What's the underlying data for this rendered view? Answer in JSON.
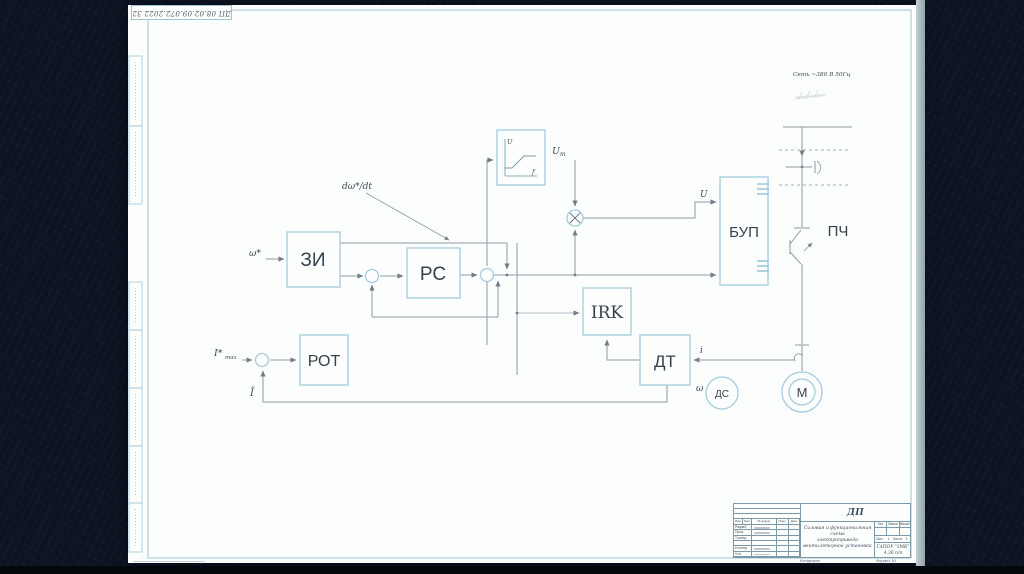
{
  "colors": {
    "background": "#0c1422",
    "sheet": "#fcfdfd",
    "frame_blue": "#9cc6d6",
    "block_blue": "#a3cbdc",
    "line_gray": "#8e9aa4",
    "text_dark": "#33424e"
  },
  "stamp": {
    "text": "ДП 08.02.09.072.2022 32"
  },
  "diagram": {
    "net": {
      "label": "Сеть ~380 В 50Гц"
    },
    "blocks": {
      "zi": "ЗИ",
      "rs": "РС",
      "rot": "РОТ",
      "irk": "IRK",
      "dt": "ДТ",
      "bup": "БУП",
      "pch": "ПЧ",
      "ds": "ДС",
      "motor": "М"
    },
    "labels": {
      "omega_star": "ω*",
      "domega": "dω*/dt",
      "um_base": "U",
      "um_sub": "m",
      "u": "U",
      "i": "i",
      "omega": "ω",
      "i_hat": "Î",
      "imax_base": "I*",
      "imax_sub": "max",
      "axis_u": "U",
      "axis_f": "f"
    }
  },
  "title_block": {
    "doc_number": "ДП 08.02.09.072.2022 32",
    "title_lines": [
      "Силовая и функциональная схема",
      "электропривода",
      "вентиляторной установки"
    ],
    "header_cols": [
      "Изм.",
      "Лист",
      "№ докум.",
      "Подп.",
      "Дата"
    ],
    "rows": [
      "Разраб.",
      "Пров.",
      "Т.контр.",
      "",
      "Н.контр.",
      "Утв."
    ],
    "lit_header": [
      "Лит.",
      "Масса",
      "Масштаб"
    ],
    "sheet_row": {
      "l1": "Лист",
      "v1": "1",
      "l2": "Листов",
      "v2": "1"
    },
    "org_lines": [
      "ГАПОУ \"ЗМК\"",
      "4.36 п/п"
    ],
    "footer_left": "Копировал",
    "footer_right": "Формат А1"
  }
}
